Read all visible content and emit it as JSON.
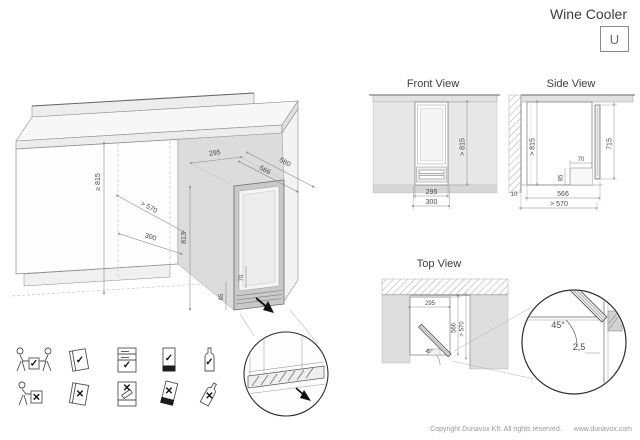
{
  "header": {
    "title": "Wine Cooler",
    "series_badge": "U"
  },
  "glyphs": {
    "check": "✓",
    "cross": "✕"
  },
  "isometric": {
    "dims": {
      "niche_height": "≥ 815",
      "niche_depth": "> 570",
      "niche_width": "300",
      "opening_width": "295",
      "unit_depth": "566",
      "depth_with_door": "580",
      "unit_height": "813",
      "vent_depth": "70",
      "vent_height": "85"
    }
  },
  "front_view": {
    "title": "Front View",
    "dims": {
      "min_height": "> 815",
      "unit_width": "295",
      "niche_width": "300"
    }
  },
  "side_view": {
    "title": "Side View",
    "dims": {
      "min_height": "> 815",
      "door_height": "715",
      "vent_depth": "70",
      "vent_height": "85",
      "unit_depth": "566",
      "niche_depth": "> 570",
      "rear_gap": "10"
    }
  },
  "top_view": {
    "title": "Top View",
    "dims": {
      "unit_width": "295",
      "unit_depth": "566",
      "niche_depth": "> 570",
      "door_angle": "45°"
    }
  },
  "door_detail": {
    "angle": "45°",
    "gap": "2,5"
  },
  "icons": [
    {
      "name": "carry-with-two-persons",
      "rule": "do"
    },
    {
      "name": "read-manual",
      "rule": "do"
    },
    {
      "name": "load-bottles-correctly",
      "rule": "do"
    },
    {
      "name": "keep-unit-upright",
      "rule": "do"
    },
    {
      "name": "store-bottles-upright",
      "rule": "do"
    },
    {
      "name": "carry-alone",
      "rule": "dont"
    },
    {
      "name": "ignore-manual",
      "rule": "dont"
    },
    {
      "name": "load-bottles-incorrectly",
      "rule": "dont"
    },
    {
      "name": "tilt-unit",
      "rule": "dont"
    },
    {
      "name": "tilt-bottles",
      "rule": "dont"
    }
  ],
  "footer": {
    "copyright": "Copyright Dunavox Kft. All rights reserved.",
    "website": "www.dunavox.com"
  }
}
